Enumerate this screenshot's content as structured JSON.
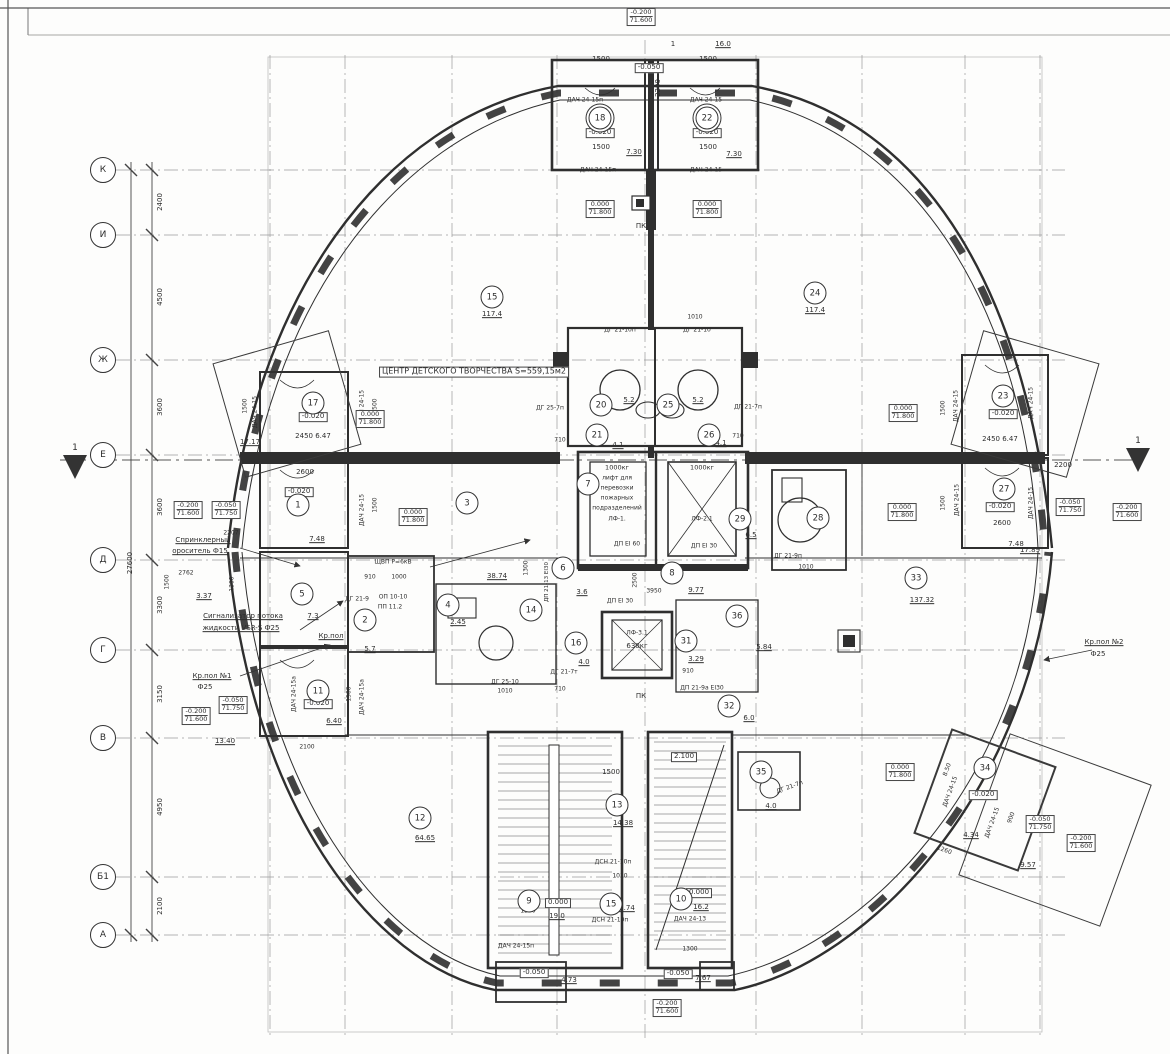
{
  "plan": {
    "title": "ЦЕНТР ДЕТСКОГО ТВОРЧЕСТВА  S=559,15м2",
    "line_color": "#3a3a3a",
    "wall_color": "#2f2f2f",
    "grid_color": "#8a8a8a"
  },
  "axes": {
    "overall": {
      "t": "27600",
      "x": 131,
      "y": 563
    },
    "rows": [
      {
        "label": "К",
        "y": 170
      },
      {
        "label": "И",
        "y": 235
      },
      {
        "label": "Ж",
        "y": 360
      },
      {
        "label": "Е",
        "y": 455
      },
      {
        "label": "Д",
        "y": 560
      },
      {
        "label": "Г",
        "y": 650
      },
      {
        "label": "В",
        "y": 738
      },
      {
        "label": "Б1",
        "y": 877
      },
      {
        "label": "А",
        "y": 935
      }
    ],
    "spans": [
      {
        "t": "2400",
        "y": 202
      },
      {
        "t": "4500",
        "y": 297
      },
      {
        "t": "3600",
        "y": 407
      },
      {
        "t": "3600",
        "y": 507
      },
      {
        "t": "3300",
        "y": 605
      },
      {
        "t": "3150",
        "y": 694
      },
      {
        "t": "4950",
        "y": 807
      },
      {
        "t": "2100",
        "y": 906
      }
    ]
  },
  "section_marks": [
    {
      "t": "1",
      "x": 75,
      "y": 449
    },
    {
      "t": "1",
      "x": 1138,
      "y": 442
    }
  ],
  "rooms": [
    {
      "num": "18",
      "x": 600,
      "y": 118,
      "d": 1
    },
    {
      "num": "22",
      "x": 707,
      "y": 118,
      "d": 1
    },
    {
      "num": "15",
      "x": 492,
      "y": 297
    },
    {
      "num": "24",
      "x": 815,
      "y": 293
    },
    {
      "num": "17",
      "x": 313,
      "y": 403
    },
    {
      "num": "23",
      "x": 1003,
      "y": 396
    },
    {
      "num": "1",
      "x": 298,
      "y": 505
    },
    {
      "num": "27",
      "x": 1004,
      "y": 489
    },
    {
      "num": "3",
      "x": 467,
      "y": 503
    },
    {
      "num": "7",
      "x": 588,
      "y": 484
    },
    {
      "num": "20",
      "x": 601,
      "y": 405
    },
    {
      "num": "25",
      "x": 668,
      "y": 405
    },
    {
      "num": "21",
      "x": 597,
      "y": 435
    },
    {
      "num": "26",
      "x": 709,
      "y": 435
    },
    {
      "num": "29",
      "x": 740,
      "y": 519
    },
    {
      "num": "28",
      "x": 818,
      "y": 518
    },
    {
      "num": "33",
      "x": 916,
      "y": 578
    },
    {
      "num": "5",
      "x": 302,
      "y": 594
    },
    {
      "num": "2",
      "x": 365,
      "y": 620
    },
    {
      "num": "4",
      "x": 448,
      "y": 605
    },
    {
      "num": "6",
      "x": 563,
      "y": 568
    },
    {
      "num": "8",
      "x": 672,
      "y": 573
    },
    {
      "num": "14",
      "x": 531,
      "y": 610
    },
    {
      "num": "16",
      "x": 576,
      "y": 643
    },
    {
      "num": "31",
      "x": 686,
      "y": 641
    },
    {
      "num": "36",
      "x": 737,
      "y": 616
    },
    {
      "num": "11",
      "x": 318,
      "y": 691
    },
    {
      "num": "32",
      "x": 729,
      "y": 706
    },
    {
      "num": "12",
      "x": 420,
      "y": 818
    },
    {
      "num": "13",
      "x": 617,
      "y": 805
    },
    {
      "num": "9",
      "x": 529,
      "y": 901
    },
    {
      "num": "10",
      "x": 681,
      "y": 899
    },
    {
      "num": "15",
      "x": 611,
      "y": 904
    },
    {
      "num": "35",
      "x": 761,
      "y": 772
    },
    {
      "num": "34",
      "x": 985,
      "y": 768
    }
  ],
  "elevations": [
    {
      "a": "-0.200",
      "b": "71.600",
      "x": 641,
      "y": 17
    },
    {
      "a": "0.000",
      "b": "71.800",
      "x": 600,
      "y": 209
    },
    {
      "a": "0.000",
      "b": "71.800",
      "x": 707,
      "y": 209
    },
    {
      "a": "0.000",
      "b": "71.800",
      "x": 370,
      "y": 419
    },
    {
      "a": "0.000",
      "b": "71.800",
      "x": 903,
      "y": 413
    },
    {
      "a": "-0.200",
      "b": "71.600",
      "x": 188,
      "y": 510
    },
    {
      "a": "-0.050",
      "b": "71.750",
      "x": 226,
      "y": 510
    },
    {
      "a": "0.000",
      "b": "71.800",
      "x": 413,
      "y": 517
    },
    {
      "a": "0.000",
      "b": "71.800",
      "x": 902,
      "y": 512
    },
    {
      "a": "-0.050",
      "b": "71.750",
      "x": 1070,
      "y": 507
    },
    {
      "a": "-0.200",
      "b": "71.600",
      "x": 1127,
      "y": 512
    },
    {
      "a": "-0.200",
      "b": "71.600",
      "x": 196,
      "y": 716
    },
    {
      "a": "-0.050",
      "b": "71.750",
      "x": 233,
      "y": 705
    },
    {
      "a": "0.000",
      "b": "71.800",
      "x": 900,
      "y": 772
    },
    {
      "a": "-0.050",
      "b": "71.750",
      "x": 1040,
      "y": 824
    },
    {
      "a": "-0.200",
      "b": "71.600",
      "x": 1081,
      "y": 843
    },
    {
      "a": "-0.200",
      "b": "71.600",
      "x": 667,
      "y": 1008
    }
  ],
  "labels": [
    {
      "t": "ЦЕНТР ДЕТСКОГО ТВОРЧЕСТВА  S=559,15м2",
      "x": 474,
      "y": 372,
      "b": 1,
      "fs": 8,
      "n": "plan-title"
    },
    {
      "t": "1500",
      "x": 601,
      "y": 60
    },
    {
      "t": "1500",
      "x": 708,
      "y": 60
    },
    {
      "t": "1",
      "x": 673,
      "y": 45
    },
    {
      "t": "16.0",
      "x": 723,
      "y": 45,
      "u": 1
    },
    {
      "t": "2200",
      "x": 659,
      "y": 88,
      "r": -90
    },
    {
      "t": "-0.050",
      "x": 649,
      "y": 68,
      "b": 1
    },
    {
      "t": "ДАЧ 24-15п",
      "x": 585,
      "y": 101,
      "fs": 6
    },
    {
      "t": "ДАЧ 24-15",
      "x": 706,
      "y": 101,
      "fs": 6
    },
    {
      "t": "-0.020",
      "x": 600,
      "y": 133,
      "b": 1
    },
    {
      "t": "-0.020",
      "x": 707,
      "y": 133,
      "b": 1
    },
    {
      "t": "2500",
      "x": 652,
      "y": 125,
      "r": -90,
      "fs": 6
    },
    {
      "t": "1500",
      "x": 601,
      "y": 148
    },
    {
      "t": "1500",
      "x": 708,
      "y": 148
    },
    {
      "t": "7.30",
      "x": 634,
      "y": 153,
      "u": 1
    },
    {
      "t": "7.30",
      "x": 734,
      "y": 155,
      "u": 1
    },
    {
      "t": "ДАЧ 24-15п",
      "x": 598,
      "y": 171,
      "fs": 6
    },
    {
      "t": "ДАЧ 24-15",
      "x": 706,
      "y": 171,
      "fs": 6
    },
    {
      "t": "ПК",
      "x": 641,
      "y": 227
    },
    {
      "t": "117.4",
      "x": 492,
      "y": 315,
      "u": 1
    },
    {
      "t": "117.4",
      "x": 815,
      "y": 311,
      "u": 1
    },
    {
      "t": "1500",
      "x": 246,
      "y": 406,
      "r": -90,
      "fs": 6
    },
    {
      "t": "ДАЧ 24-15",
      "x": 256,
      "y": 412,
      "r": -90,
      "fs": 6
    },
    {
      "t": "ДАЧ 24-15",
      "x": 363,
      "y": 406,
      "r": -90,
      "fs": 6
    },
    {
      "t": "1500",
      "x": 376,
      "y": 406,
      "r": -90,
      "fs": 6
    },
    {
      "t": "-0.020",
      "x": 313,
      "y": 417,
      "b": 1
    },
    {
      "t": "17.17",
      "x": 250,
      "y": 443,
      "u": 1
    },
    {
      "t": "2450 6.47",
      "x": 313,
      "y": 437
    },
    {
      "t": "2600",
      "x": 305,
      "y": 473
    },
    {
      "t": "-0.020",
      "x": 299,
      "y": 492,
      "b": 1
    },
    {
      "t": "1500",
      "x": 376,
      "y": 505,
      "r": -90,
      "fs": 6
    },
    {
      "t": "ДАЧ 24-15",
      "x": 363,
      "y": 510,
      "r": -90,
      "fs": 6
    },
    {
      "t": "7.48",
      "x": 317,
      "y": 540,
      "u": 1
    },
    {
      "t": "2207",
      "x": 231,
      "y": 534,
      "fs": 6
    },
    {
      "t": "Спринклерный",
      "x": 203,
      "y": 541,
      "u": 1
    },
    {
      "t": "ороситель Ф15",
      "x": 200,
      "y": 552,
      "u": 1
    },
    {
      "t": "2762",
      "x": 186,
      "y": 574,
      "fs": 6
    },
    {
      "t": "1500",
      "x": 168,
      "y": 582,
      "r": -90,
      "fs": 6
    },
    {
      "t": "1300",
      "x": 233,
      "y": 584,
      "r": -90,
      "fs": 6
    },
    {
      "t": "3.37",
      "x": 204,
      "y": 597,
      "u": 1
    },
    {
      "t": "Сигнализатор потока",
      "x": 243,
      "y": 617,
      "u": 1
    },
    {
      "t": "жидкости VSR-S Ф25",
      "x": 241,
      "y": 629,
      "u": 1
    },
    {
      "t": "ДГ 21-9",
      "x": 357,
      "y": 600,
      "fs": 6
    },
    {
      "t": "910",
      "x": 370,
      "y": 578,
      "fs": 6
    },
    {
      "t": "1000",
      "x": 399,
      "y": 578,
      "fs": 6
    },
    {
      "t": "ЩВП Р=6кВ",
      "x": 393,
      "y": 563,
      "fs": 6
    },
    {
      "t": "ОП 10-10",
      "x": 393,
      "y": 598,
      "fs": 6
    },
    {
      "t": "ПП 11.2",
      "x": 390,
      "y": 608,
      "fs": 6
    },
    {
      "t": "7.3",
      "x": 313,
      "y": 617,
      "u": 1
    },
    {
      "t": "Кр.пол",
      "x": 331,
      "y": 637,
      "u": 1
    },
    {
      "t": "5.7",
      "x": 370,
      "y": 650,
      "u": 1
    },
    {
      "t": "Кр.пол №1",
      "x": 212,
      "y": 677,
      "u": 1
    },
    {
      "t": "Ф25",
      "x": 205,
      "y": 688
    },
    {
      "t": "ДАЧ 24-15а",
      "x": 295,
      "y": 694,
      "r": -90,
      "fs": 6
    },
    {
      "t": "ДАЧ 24-15а",
      "x": 363,
      "y": 697,
      "r": -90,
      "fs": 6
    },
    {
      "t": "1500",
      "x": 350,
      "y": 694,
      "r": -90,
      "fs": 6
    },
    {
      "t": "-0.020",
      "x": 318,
      "y": 704,
      "b": 1
    },
    {
      "t": "6.40",
      "x": 334,
      "y": 722,
      "u": 1
    },
    {
      "t": "13.40",
      "x": 225,
      "y": 742,
      "u": 1
    },
    {
      "t": "2100",
      "x": 307,
      "y": 748,
      "fs": 6
    },
    {
      "t": "ДГ 25-7п",
      "x": 550,
      "y": 409,
      "fs": 6
    },
    {
      "t": "710",
      "x": 560,
      "y": 441,
      "fs": 6
    },
    {
      "t": "ДГ 21-7п",
      "x": 748,
      "y": 408,
      "fs": 6
    },
    {
      "t": "710",
      "x": 738,
      "y": 437,
      "fs": 6
    },
    {
      "t": "1010",
      "x": 695,
      "y": 318,
      "fs": 6
    },
    {
      "t": "ДГ 21-10п",
      "x": 620,
      "y": 331,
      "fs": 6
    },
    {
      "t": "ДГ 21-10",
      "x": 697,
      "y": 331,
      "fs": 6
    },
    {
      "t": "5.2",
      "x": 629,
      "y": 401,
      "u": 1
    },
    {
      "t": "5.2",
      "x": 698,
      "y": 401,
      "u": 1
    },
    {
      "t": "4.1",
      "x": 618,
      "y": 446,
      "u": 1
    },
    {
      "t": "4.1",
      "x": 721,
      "y": 444,
      "u": 1
    },
    {
      "t": "1000кг",
      "x": 617,
      "y": 468,
      "fs": 6.5
    },
    {
      "t": "лифт для",
      "x": 617,
      "y": 479,
      "fs": 6
    },
    {
      "t": "перевозки",
      "x": 617,
      "y": 489,
      "fs": 6
    },
    {
      "t": "пожарных",
      "x": 617,
      "y": 499,
      "fs": 6
    },
    {
      "t": "подразделений",
      "x": 617,
      "y": 509,
      "fs": 6
    },
    {
      "t": "ЛФ-1.",
      "x": 617,
      "y": 520,
      "fs": 6
    },
    {
      "t": "1000кг",
      "x": 702,
      "y": 468,
      "fs": 6.5
    },
    {
      "t": "ЛФ-2.1",
      "x": 702,
      "y": 520,
      "fs": 6
    },
    {
      "t": "ДП ЕІ 60",
      "x": 627,
      "y": 545,
      "fs": 6
    },
    {
      "t": "ДП ЕІ 30",
      "x": 704,
      "y": 547,
      "fs": 6
    },
    {
      "t": "6.5",
      "x": 751,
      "y": 536,
      "u": 1
    },
    {
      "t": "ДГ 21-9п",
      "x": 788,
      "y": 557,
      "fs": 6
    },
    {
      "t": "1010",
      "x": 806,
      "y": 568,
      "fs": 6
    },
    {
      "t": "1500",
      "x": 944,
      "y": 408,
      "r": -90,
      "fs": 6
    },
    {
      "t": "ДАЧ 24-15",
      "x": 957,
      "y": 406,
      "r": -90,
      "fs": 6
    },
    {
      "t": "ДАЧ 24-15",
      "x": 1032,
      "y": 403,
      "r": -90,
      "fs": 6
    },
    {
      "t": "-0.020",
      "x": 1003,
      "y": 414,
      "b": 1
    },
    {
      "t": "2450 6.47",
      "x": 1000,
      "y": 440
    },
    {
      "t": "2200",
      "x": 1063,
      "y": 466
    },
    {
      "t": "-0.020",
      "x": 1000,
      "y": 507,
      "b": 1
    },
    {
      "t": "1500",
      "x": 944,
      "y": 503,
      "r": -90,
      "fs": 6
    },
    {
      "t": "ДАЧ 24-15",
      "x": 958,
      "y": 500,
      "r": -90,
      "fs": 6
    },
    {
      "t": "ДАЧ 24-15",
      "x": 1032,
      "y": 503,
      "r": -90,
      "fs": 6
    },
    {
      "t": "2600",
      "x": 1002,
      "y": 524
    },
    {
      "t": "7.48",
      "x": 1016,
      "y": 545,
      "u": 1
    },
    {
      "t": "17.89",
      "x": 1030,
      "y": 551,
      "u": 1
    },
    {
      "t": "137.32",
      "x": 922,
      "y": 601,
      "u": 1
    },
    {
      "t": "38.74",
      "x": 497,
      "y": 577,
      "u": 1
    },
    {
      "t": "1300",
      "x": 527,
      "y": 568,
      "r": -90,
      "fs": 6
    },
    {
      "t": "ДП 21-13 ЕІ30",
      "x": 547,
      "y": 582,
      "r": -90,
      "fs": 5.5
    },
    {
      "t": "3.6",
      "x": 582,
      "y": 593,
      "u": 1
    },
    {
      "t": "2500",
      "x": 636,
      "y": 580,
      "r": -90,
      "fs": 6
    },
    {
      "t": "3950",
      "x": 654,
      "y": 592,
      "fs": 6
    },
    {
      "t": "9.77",
      "x": 696,
      "y": 591,
      "u": 1
    },
    {
      "t": "ДП ЕІ 30",
      "x": 620,
      "y": 602,
      "fs": 6
    },
    {
      "t": "2.45",
      "x": 458,
      "y": 623,
      "u": 1
    },
    {
      "t": "ДГ 25-10",
      "x": 505,
      "y": 683,
      "fs": 6
    },
    {
      "t": "1010",
      "x": 505,
      "y": 692,
      "fs": 6
    },
    {
      "t": "4.0",
      "x": 584,
      "y": 663,
      "u": 1
    },
    {
      "t": "ДГ 21-7т",
      "x": 564,
      "y": 673,
      "fs": 6
    },
    {
      "t": "710",
      "x": 560,
      "y": 690,
      "fs": 6
    },
    {
      "t": "ЛФ-3.1",
      "x": 637,
      "y": 634,
      "fs": 6
    },
    {
      "t": "630кг",
      "x": 637,
      "y": 647
    },
    {
      "t": "3.29",
      "x": 696,
      "y": 660,
      "u": 1
    },
    {
      "t": "910",
      "x": 688,
      "y": 672,
      "fs": 6
    },
    {
      "t": "5.84",
      "x": 764,
      "y": 648,
      "u": 1
    },
    {
      "t": "ПК",
      "x": 641,
      "y": 697
    },
    {
      "t": "ДП 21-9а ЕІ30",
      "x": 702,
      "y": 689,
      "fs": 6
    },
    {
      "t": "6.0",
      "x": 749,
      "y": 719,
      "u": 1
    },
    {
      "t": "2.100",
      "x": 684,
      "y": 757,
      "b": 1
    },
    {
      "t": "1500",
      "x": 611,
      "y": 773
    },
    {
      "t": "14.38",
      "x": 623,
      "y": 824,
      "u": 1
    },
    {
      "t": "ДСН 21-10п",
      "x": 613,
      "y": 863,
      "fs": 6
    },
    {
      "t": "1010",
      "x": 620,
      "y": 877,
      "fs": 6
    },
    {
      "t": "0.000",
      "x": 558,
      "y": 903,
      "b": 1
    },
    {
      "t": "19.0",
      "x": 557,
      "y": 917,
      "u": 1
    },
    {
      "t": "1300",
      "x": 528,
      "y": 912,
      "fs": 6
    },
    {
      "t": "0.000",
      "x": 699,
      "y": 893,
      "b": 1
    },
    {
      "t": "16.2",
      "x": 701,
      "y": 908,
      "u": 1
    },
    {
      "t": "ДАЧ 24-13",
      "x": 690,
      "y": 920,
      "fs": 6
    },
    {
      "t": "1.74",
      "x": 627,
      "y": 909,
      "u": 1
    },
    {
      "t": "ДСН 21-10п",
      "x": 610,
      "y": 921,
      "fs": 6
    },
    {
      "t": "ДАЧ 24-15п",
      "x": 516,
      "y": 947,
      "fs": 6
    },
    {
      "t": "1300",
      "x": 690,
      "y": 950,
      "fs": 6
    },
    {
      "t": "-0.050",
      "x": 534,
      "y": 973,
      "b": 1
    },
    {
      "t": "4.73",
      "x": 569,
      "y": 981,
      "u": 1
    },
    {
      "t": "-0.050",
      "x": 678,
      "y": 974,
      "b": 1
    },
    {
      "t": "7.67",
      "x": 703,
      "y": 979,
      "u": 1
    },
    {
      "t": "64.65",
      "x": 425,
      "y": 839,
      "u": 1
    },
    {
      "t": "ДГ 21-7п",
      "x": 790,
      "y": 788,
      "r": -20,
      "fs": 6
    },
    {
      "t": "4.0",
      "x": 771,
      "y": 807,
      "u": 1
    },
    {
      "t": "-0.020",
      "x": 983,
      "y": 795,
      "b": 1
    },
    {
      "t": "ДАЧ 24-15",
      "x": 951,
      "y": 792,
      "r": -70,
      "fs": 6
    },
    {
      "t": "ДАЧ 24-15",
      "x": 993,
      "y": 823,
      "r": -70,
      "fs": 6
    },
    {
      "t": "8.50",
      "x": 948,
      "y": 770,
      "r": -70,
      "fs": 6
    },
    {
      "t": "900",
      "x": 1012,
      "y": 818,
      "r": -70,
      "fs": 6
    },
    {
      "t": "1260",
      "x": 944,
      "y": 851,
      "r": 20,
      "fs": 6
    },
    {
      "t": "4.34",
      "x": 971,
      "y": 836,
      "u": 1
    },
    {
      "t": "9.57",
      "x": 1028,
      "y": 866,
      "u": 1
    },
    {
      "t": "Кр.пол №2",
      "x": 1104,
      "y": 643,
      "u": 1
    },
    {
      "t": "Ф25",
      "x": 1098,
      "y": 655
    }
  ]
}
